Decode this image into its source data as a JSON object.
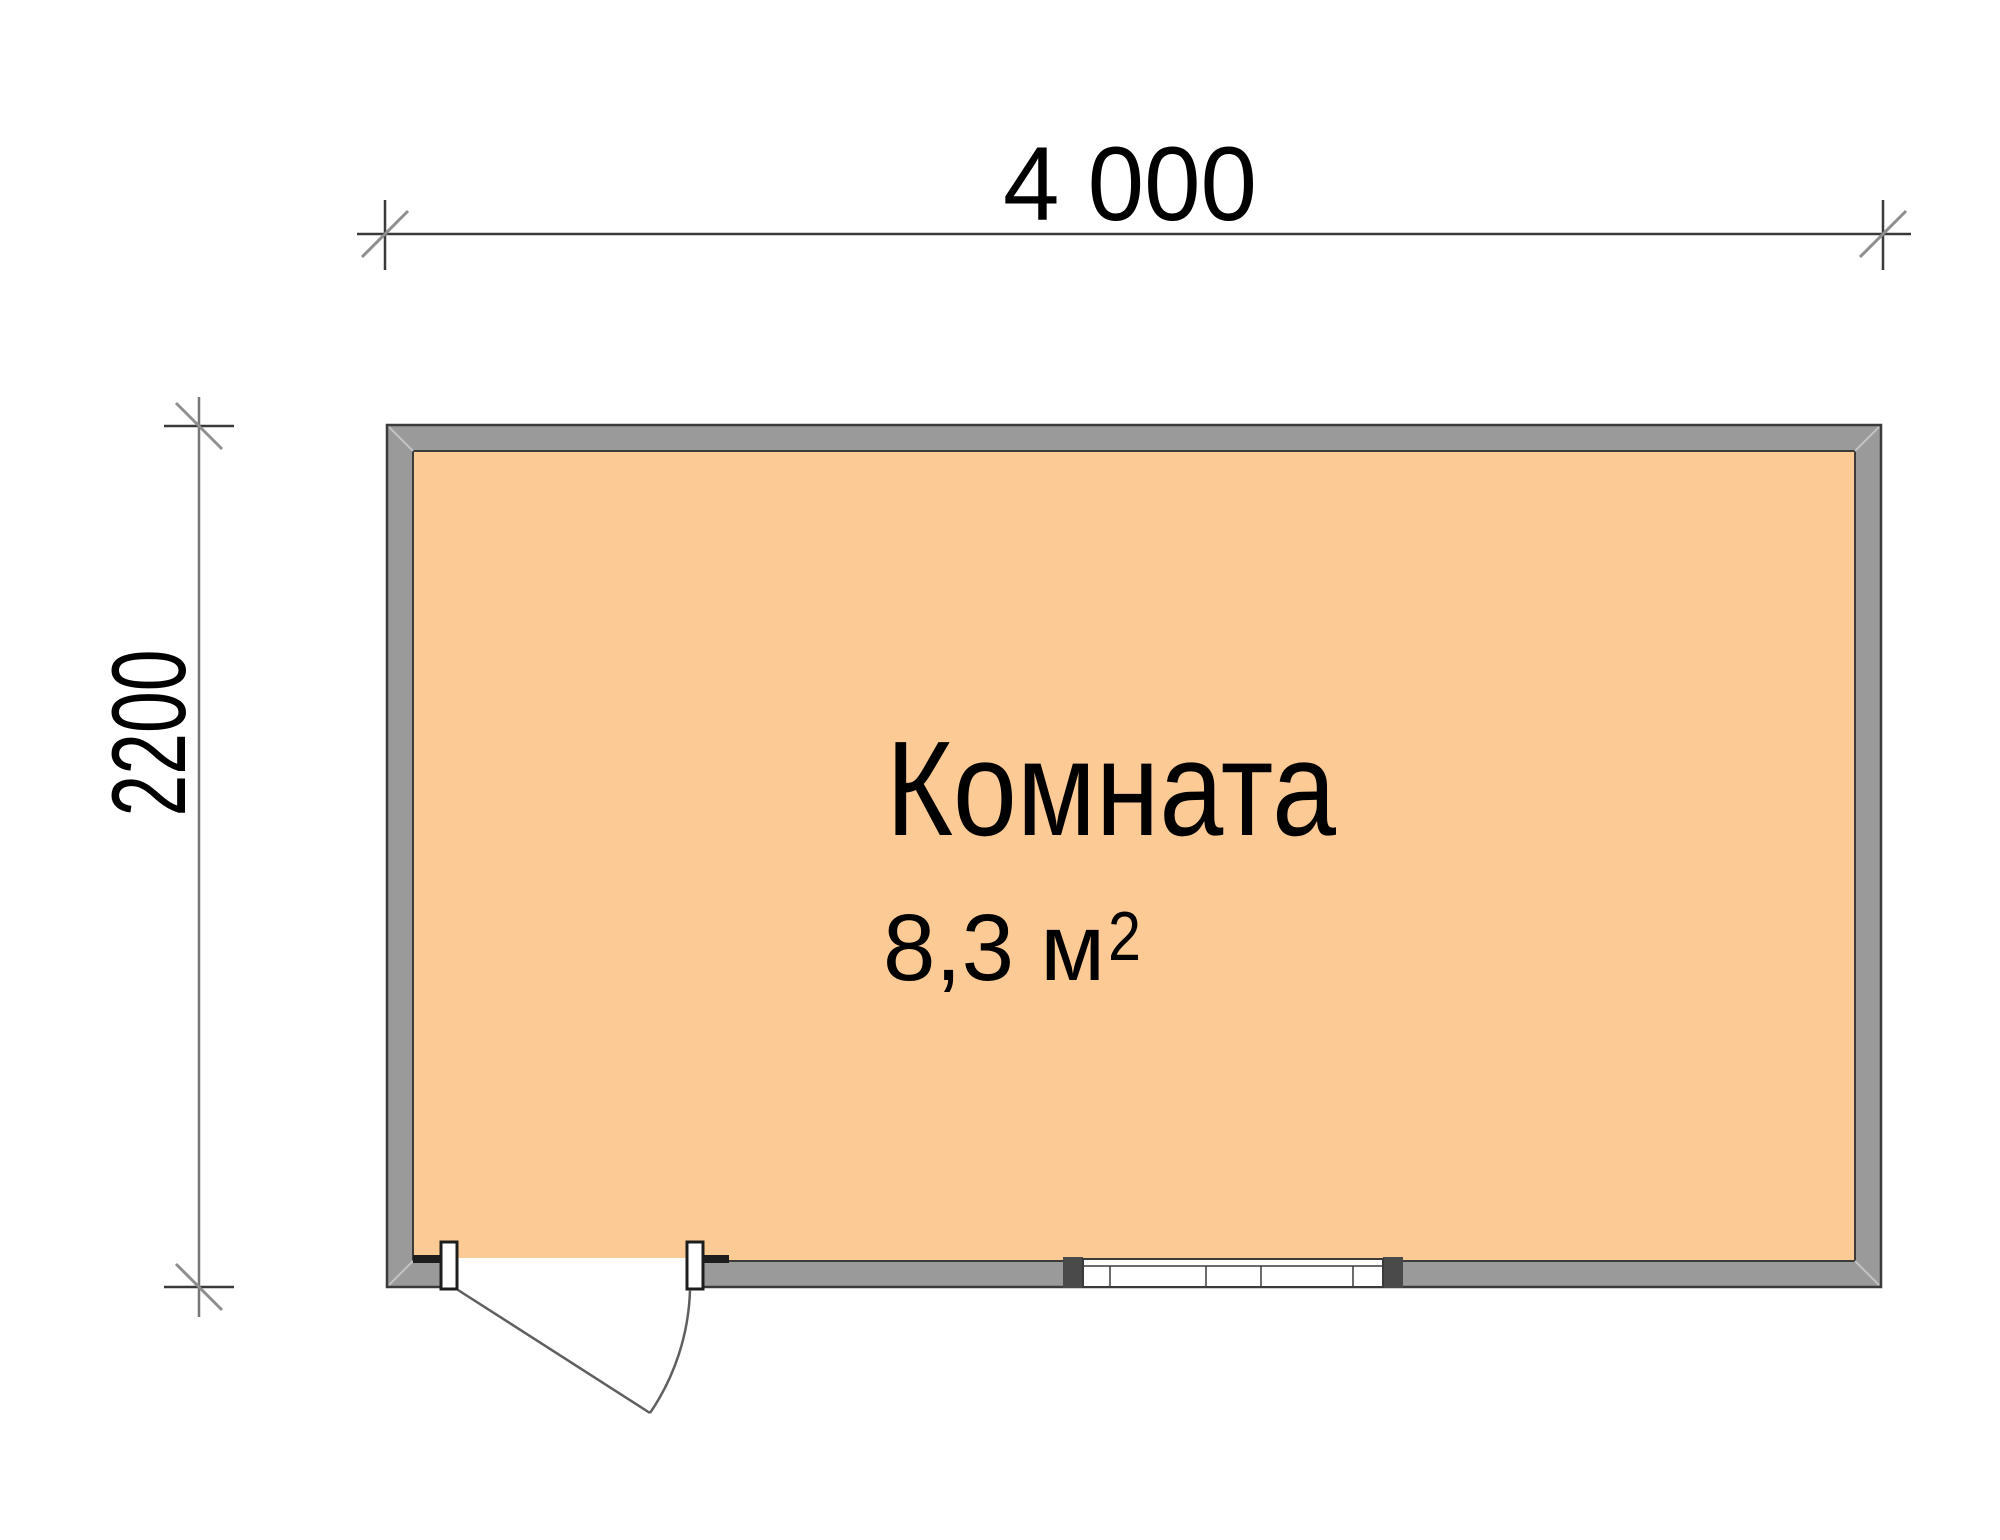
{
  "plan": {
    "dimension_width": {
      "label": "4 000"
    },
    "dimension_height": {
      "label": "2200"
    },
    "room": {
      "name": "Комната",
      "area": "8,3 м",
      "area_superscript": "2"
    }
  },
  "colors": {
    "floor_fill": "#fcca95",
    "wall_fill": "#9a9a9a",
    "wall_outline": "#3b3b3b",
    "miter_line": "#c2c2c2",
    "dim_line": "#3a3a3a",
    "dim_line_light": "#777777",
    "dim_slash": "#8f8f8f",
    "window_cap": "#4a4a4a",
    "door_line": "#5f5f5f"
  }
}
